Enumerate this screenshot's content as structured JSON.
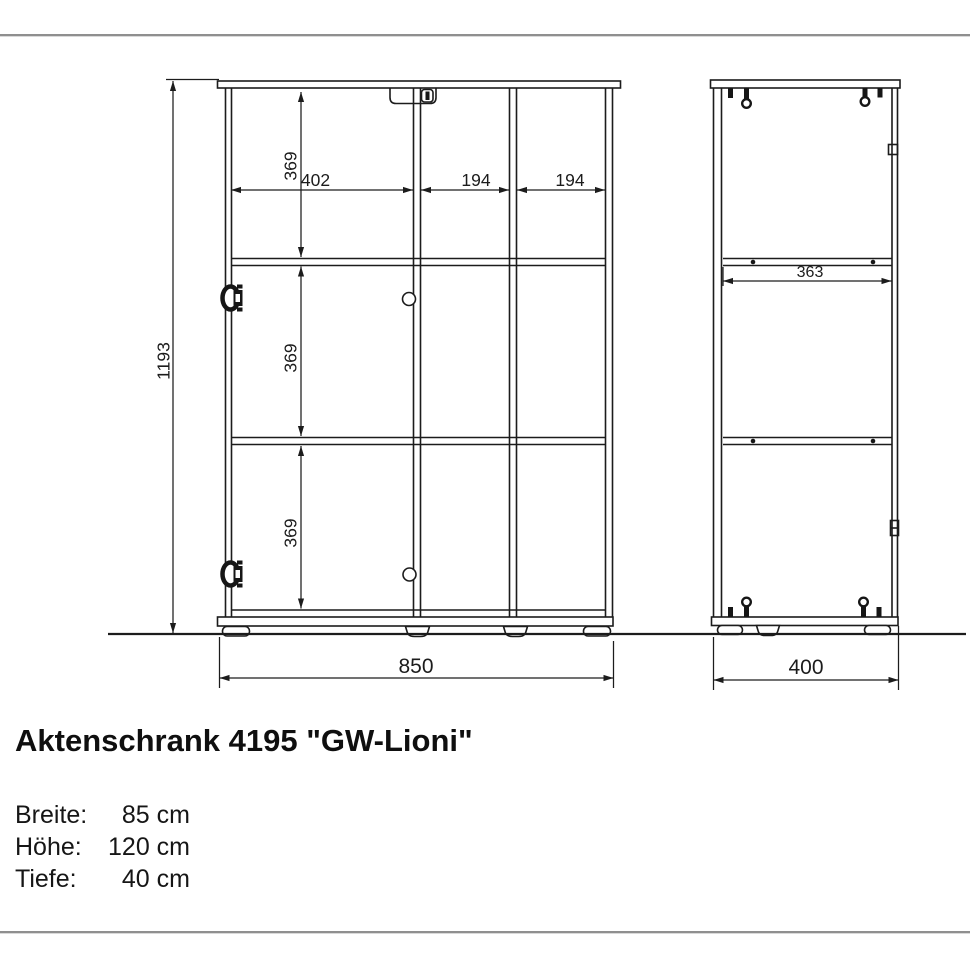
{
  "product": {
    "title": "Aktenschrank 4195 \"GW-Lioni\"",
    "specs": [
      {
        "label": "Breite:",
        "value": "85 cm"
      },
      {
        "label": "Höhe:",
        "value": "120 cm"
      },
      {
        "label": "Tiefe:",
        "value": "40 cm"
      }
    ]
  },
  "drawing": {
    "front_view": {
      "total_height_mm": "1193",
      "total_width_mm": "850",
      "left_compartment_width_mm": "402",
      "middle_compartment_width_mm": "194",
      "right_compartment_width_mm": "194",
      "top_section_height_mm": "369",
      "middle_section_height_mm": "369",
      "bottom_section_height_mm": "369"
    },
    "side_view": {
      "shelf_depth_mm": "363",
      "total_depth_mm": "400"
    },
    "colors": {
      "line": "#1c1c1c",
      "divider_rule": "#8f8f8f"
    }
  }
}
